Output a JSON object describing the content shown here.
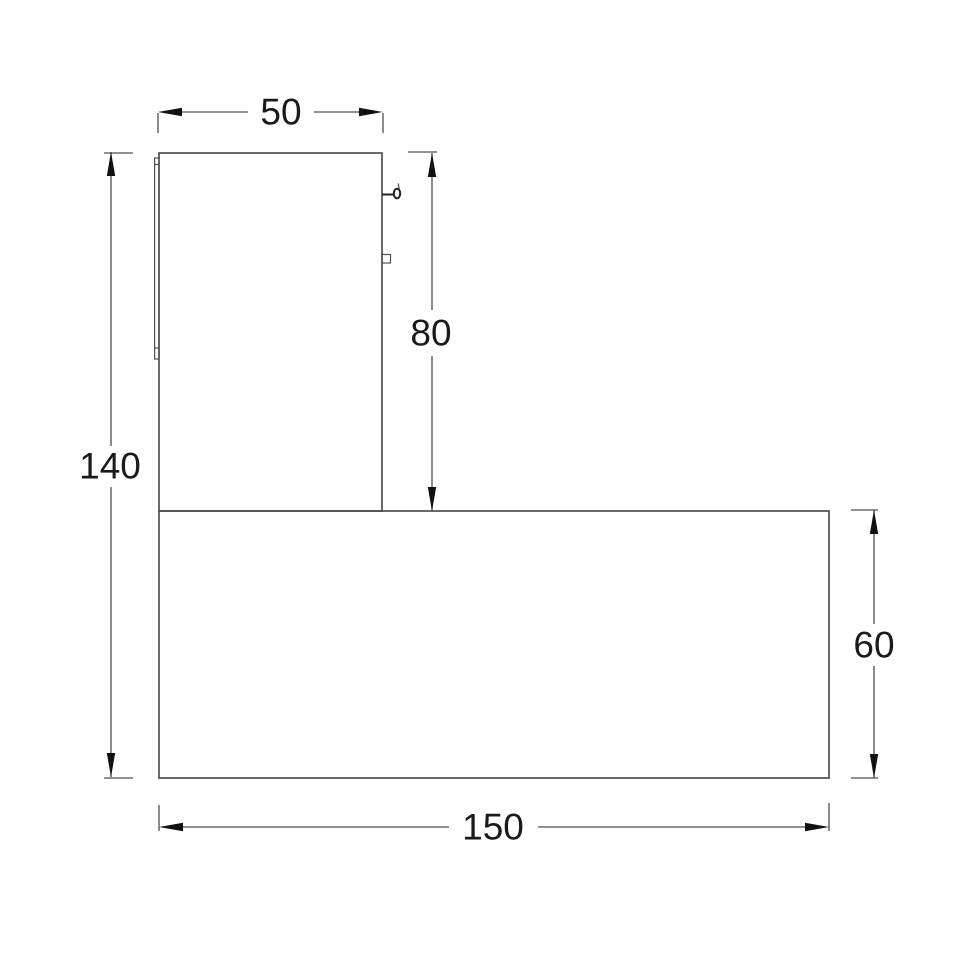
{
  "dimensions": {
    "top_width": "50",
    "left_height": "140",
    "upper_right_height": "80",
    "lower_right_height": "60",
    "bottom_width": "150"
  },
  "colors": {
    "background": "#ffffff",
    "line": "#4f4f4f",
    "detail": "#222222",
    "arrow": "#111111",
    "text": "#1a1a1a"
  }
}
